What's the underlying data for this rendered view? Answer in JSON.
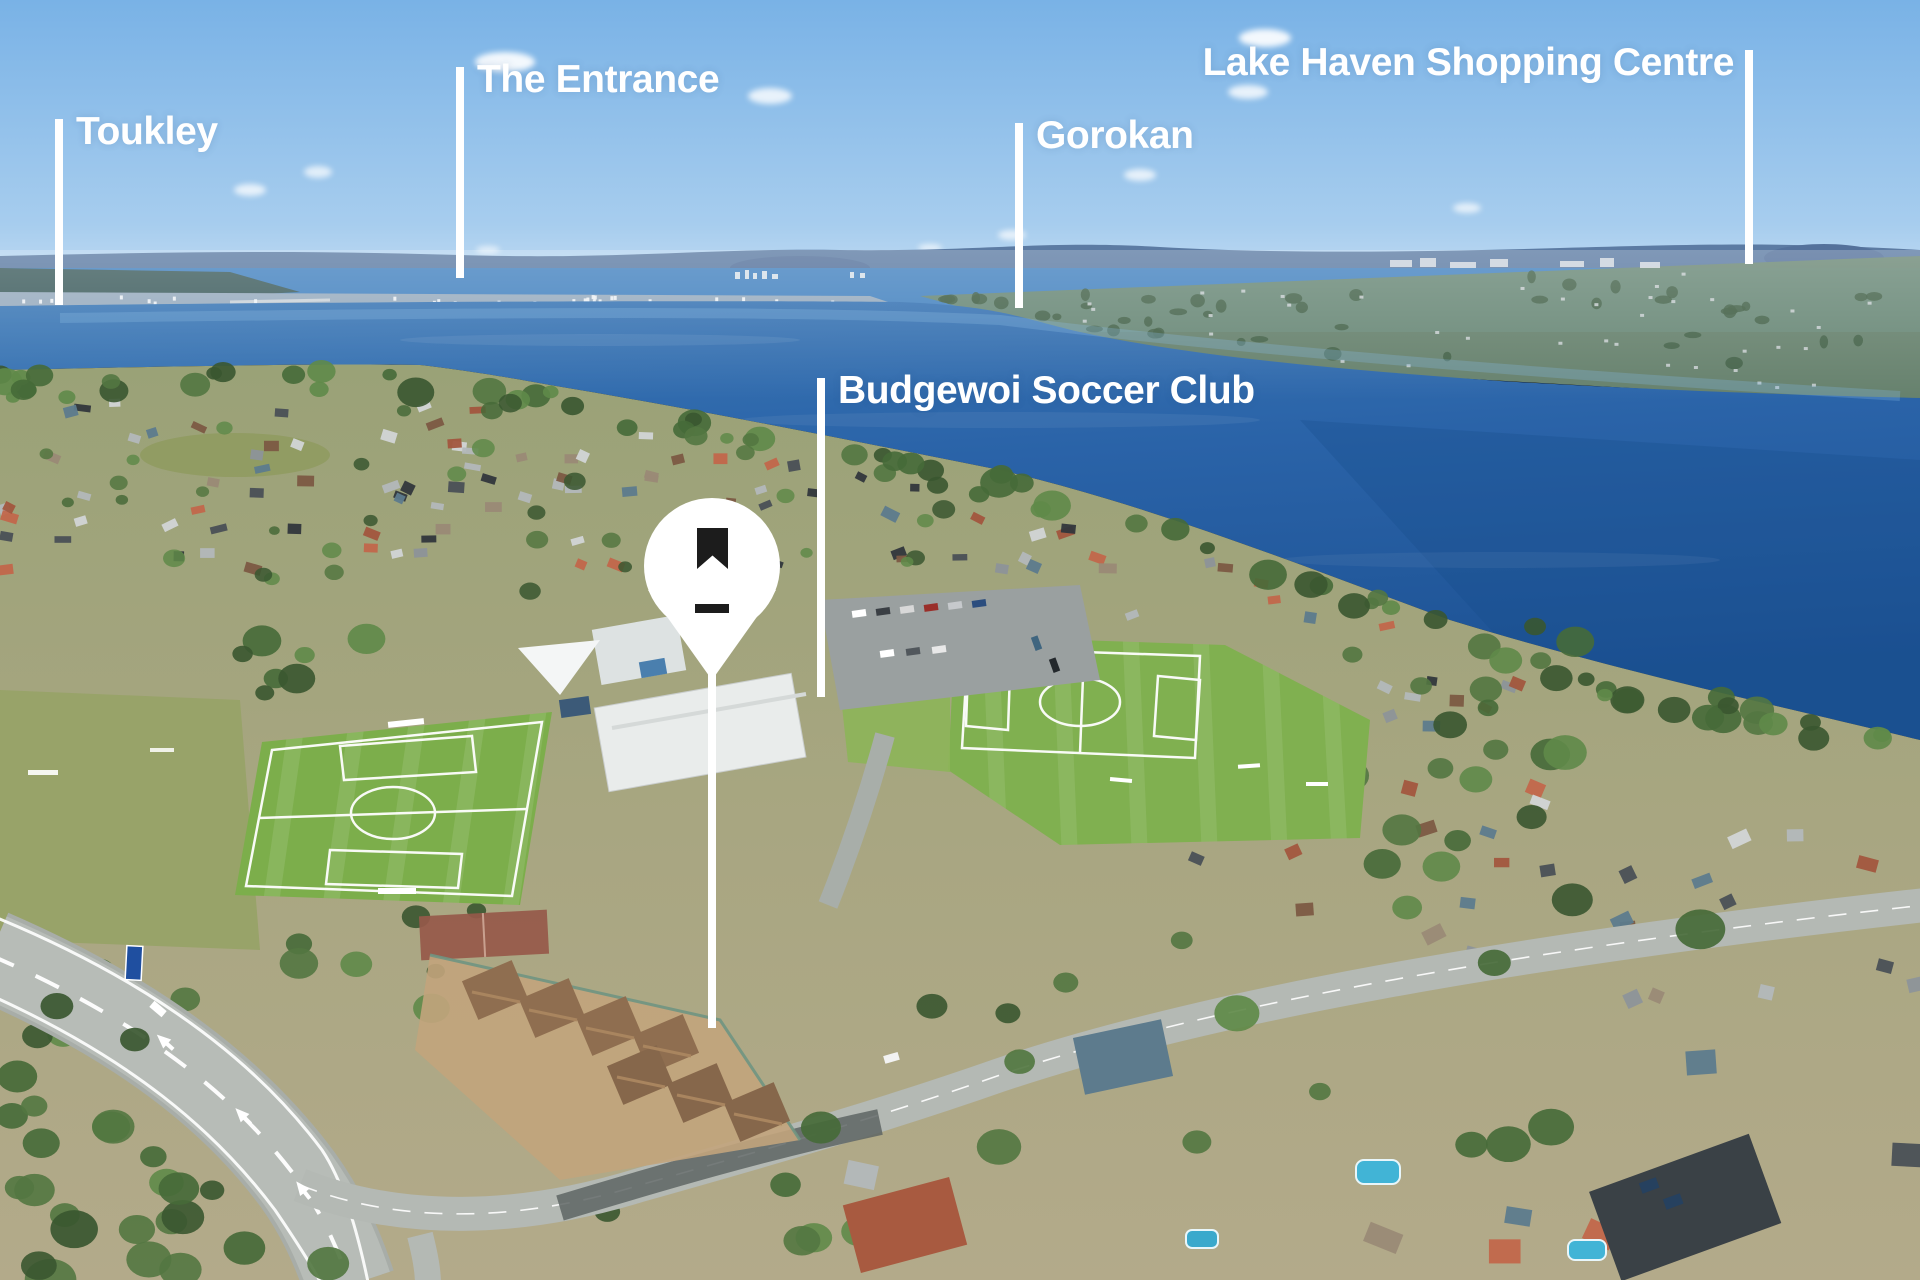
{
  "page": {
    "type": "aerial-photograph-with-annotations",
    "subject": "lakeside suburb with soccer fields and a marked property"
  },
  "annotations": {
    "labels": [
      {
        "id": "toukley",
        "text": "Toukley",
        "pointer": "vertical-line-below-left"
      },
      {
        "id": "the-entrance",
        "text": "The Entrance",
        "pointer": "vertical-line-below-left"
      },
      {
        "id": "gorokan",
        "text": "Gorokan",
        "pointer": "vertical-line-below-left"
      },
      {
        "id": "lake-haven-shopping-centre",
        "text": "Lake Haven Shopping Centre",
        "pointer": "vertical-line-below-right"
      },
      {
        "id": "budgewoi-soccer-club",
        "text": "Budgewoi Soccer Club",
        "pointer": "vertical-line-below-left"
      }
    ],
    "marker": {
      "name": "property-location-pin",
      "icons": [
        "bookmark-icon",
        "dash-icon"
      ],
      "pin_color": "#ffffff",
      "glyph_color": "#1c1c1c"
    },
    "label_text_color": "#ffffff"
  },
  "scene": {
    "key_colors": {
      "sky": "#7ab3e6",
      "lake": "#2a63a8",
      "distant_hills": "#5c7ba3",
      "soccer_field": "#7cae4b",
      "road": "#b6bbb6",
      "tree": "#466a38",
      "pool": "#41b4d6"
    },
    "features": [
      "lake",
      "distant-hills",
      "far-shore-towns",
      "suburb",
      "two-soccer-fields",
      "clubhouse-and-carpark",
      "curving-main-road",
      "unit-complex",
      "tree-belts",
      "pools"
    ]
  }
}
